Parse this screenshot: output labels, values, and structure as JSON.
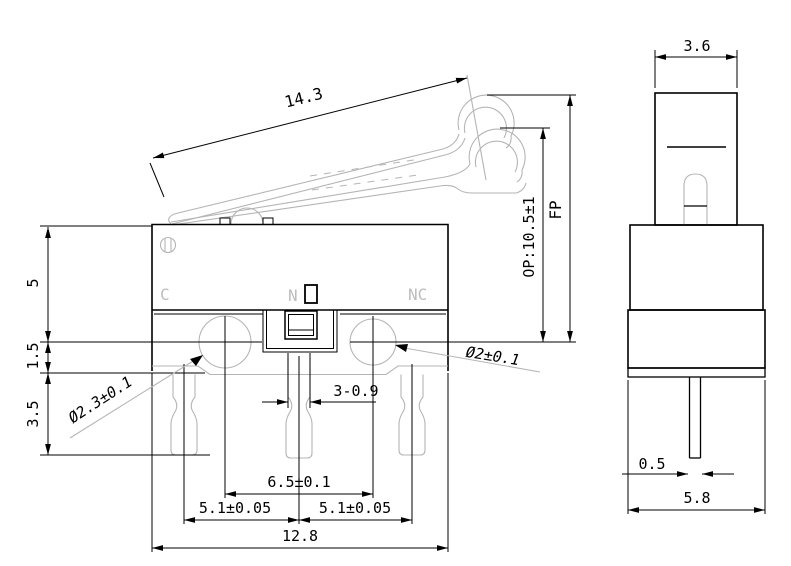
{
  "drawing": {
    "front": {
      "contact_labels": {
        "c": "C",
        "n": "N",
        "nc": "NC"
      },
      "dims": {
        "lever_length": "14.3",
        "top_to_hole": "5",
        "hole_to_base": "1.5",
        "base_to_pin": "3.5",
        "left_hole": "Ø2.3±0.1",
        "right_hole": "Ø2±0.1",
        "pin_width": "3-0.9",
        "hole_pitch": "6.5±0.1",
        "pin_pitch_left": "5.1±0.05",
        "pin_pitch_right": "5.1±0.05",
        "body_width": "12.8",
        "op": "OP:10.5±1",
        "fp": "FP"
      }
    },
    "side": {
      "dims": {
        "lever_width": "3.6",
        "pin_thickness": "0.5",
        "body_depth": "5.8"
      }
    },
    "colors": {
      "line": "#000000",
      "light_line": "#b5b5b5",
      "background": "#ffffff"
    }
  }
}
